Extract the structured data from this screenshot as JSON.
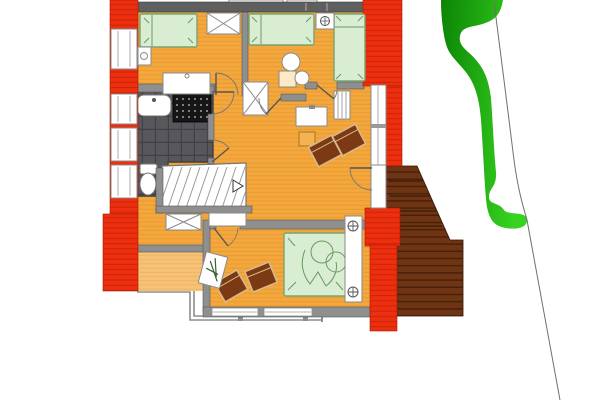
{
  "meta": {
    "drawing_type": "architectural-floor-plan",
    "level": "upper-floor",
    "visible_text": "none"
  },
  "colors": {
    "background": "#ffffff",
    "wall_red": "#ee2f0f",
    "wall_red_line": "#b71e03",
    "wall_gray": "#8f8f8f",
    "wall_dark": "#5f5f5f",
    "floor": "#f3a73d",
    "floor_line": "#d98d21",
    "terrace": "#f7c276",
    "bath_floor": "#58585c",
    "bath_grid": "#44444a",
    "shower": "#161616",
    "bed_fill": "#d9edd3",
    "bed_stroke": "#79a471",
    "furniture_white": "#ffffff",
    "chair": "#7b3a13",
    "chair_trim": "#d8b98a",
    "deck": "#6e3413",
    "deck_line": "#401d08",
    "tree_dark": "#0c8406",
    "tree_light": "#37d31f",
    "railing": "#8d8d8d",
    "boundary_line": "#6f6f6f",
    "stool": "#f4b353"
  },
  "rooms": [
    {
      "id": "bedroom-nw",
      "furniture": [
        "single-bed",
        "nightstand",
        "desk",
        "west-window",
        "chimney-shaft-crossed"
      ]
    },
    {
      "id": "bedroom-n",
      "furniture": [
        "single-bed",
        "nightstand-with-lamp",
        "round-table",
        "square-stool",
        "round-stool",
        "chimney-shaft-crossed"
      ]
    },
    {
      "id": "bedroom-ne",
      "furniture": [
        "single-bed",
        "radiator"
      ]
    },
    {
      "id": "bathroom",
      "floor": "dark-tile",
      "furniture": [
        "washbasin",
        "shower",
        "toilet"
      ]
    },
    {
      "id": "hallway",
      "furniture": [
        "winder-staircase",
        "direction-arrow",
        "crossed-dresser",
        "sideboard"
      ]
    },
    {
      "id": "living-area",
      "furniture": [
        "armchair-1",
        "armchair-2",
        "sideboard",
        "stool",
        "balcony-door"
      ]
    },
    {
      "id": "bedroom-s",
      "furniture": [
        "double-bed",
        "headboard-with-two-lamps",
        "armchair-1",
        "armchair-2",
        "plant-stand",
        "south-windows"
      ]
    }
  ],
  "exterior": {
    "elements": [
      "balcony-railing",
      "terrace",
      "wooden-deck-stairs",
      "tree-hedge",
      "property-boundary-line",
      "roof-dormer-boxes"
    ]
  }
}
